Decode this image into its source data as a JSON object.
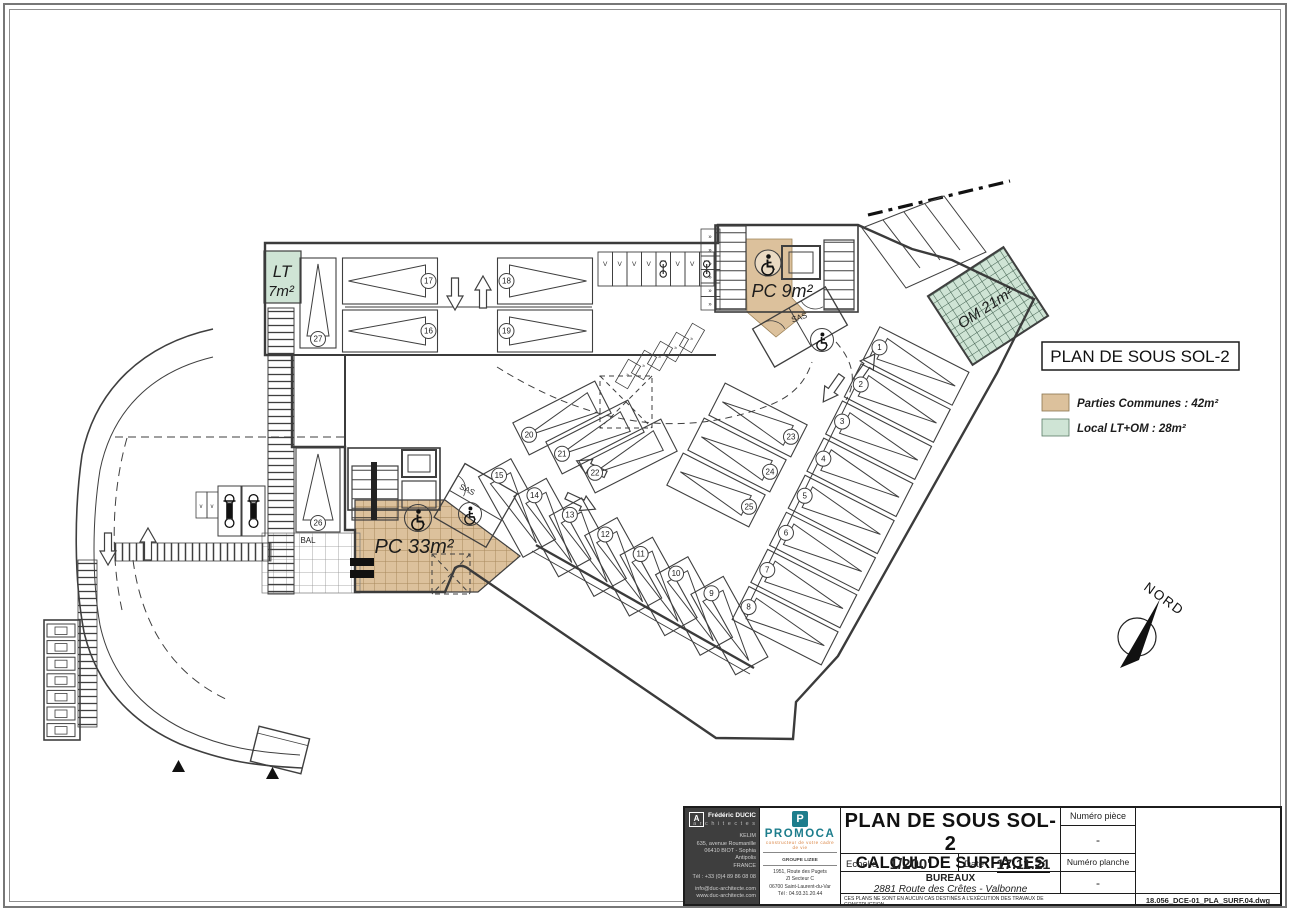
{
  "plan": {
    "sheet_title": "PLAN DE SOUS SOL-2",
    "legend": {
      "items": [
        {
          "label": "Parties Communes : 42m²",
          "color": "#dcc19c"
        },
        {
          "label": "Local LT+OM : 28m²",
          "color": "#cfe4d5"
        }
      ]
    },
    "north": {
      "label": "NORD"
    },
    "labels": {
      "lt_name": "LT",
      "lt_area": "7m²",
      "pc9": "PC 9m²",
      "pc33": "PC 33m²",
      "om": "OM 21m²",
      "sas_top": "SAS",
      "sas_mid": "SAS",
      "bal": "BAL"
    },
    "stall_numbers": {
      "top_upper": [
        17,
        18
      ],
      "top_lower": [
        16,
        19
      ],
      "ramp": [
        27
      ],
      "tall": [
        26
      ],
      "middle_left": [
        20,
        21,
        22
      ],
      "middle_right": [
        23,
        24,
        25
      ],
      "right_column": [
        1,
        2,
        3,
        4,
        5,
        6,
        7,
        8
      ],
      "bottom_row": [
        15,
        14,
        13,
        12,
        11,
        10,
        9
      ]
    },
    "bike_row": [
      "V",
      "V",
      "V",
      "V",
      "bike",
      "V",
      "V",
      "bike"
    ],
    "colors": {
      "commons": "#dcc19c",
      "local": "#cfe4d5",
      "line": "#3f3f3f",
      "teal": "#1d7d8c"
    }
  },
  "titleblock": {
    "architect": {
      "name": "Frédéric DUCIC",
      "profession": "a r c h i t e c t e s",
      "addr1": "KELIM",
      "addr2": "635, avenue Roumanille",
      "addr3": "06410 BIOT - Sophia Antipolis",
      "addr4": "FRANCE",
      "tel": "Tél : +33 (0)4 89 86 08 08",
      "email": "info@duc-architecte.com",
      "web": "www.duc-architecte.com"
    },
    "builder": {
      "logo_letter": "P",
      "name": "PROMOCA",
      "tagline": "constructeur de votre cadre de vie",
      "group": "GROUPE LIZEE",
      "addr1": "1951, Route des Pugets",
      "addr2": "ZI Secteur C",
      "addr3": "06700 Saint-Laurent-du-Var",
      "addr4": "Tél : 04.93.31.20.44"
    },
    "title_line1": "PLAN DE SOUS SOL-2",
    "title_line2": "CALCUL DE SURFACES",
    "scale_label": "Echelle",
    "scale_value": "1/200'",
    "date_label": "Date",
    "date_value": "17.11.21",
    "project_type": "BUREAUX",
    "project_address": "2881 Route des Crêtes - Valbonne",
    "disclaimer": "CES PLANS NE SONT EN AUCUN CAS DESTINÉS A L'EXÉCUTION DES TRAVAUX DE CONSTRUCTION.",
    "piece_label": "Numéro pièce",
    "piece_value": "-",
    "sheet_label": "Numéro planche",
    "sheet_value": "-",
    "filename": "18.056_DCE-01_PLA_SURF.04.dwg"
  }
}
